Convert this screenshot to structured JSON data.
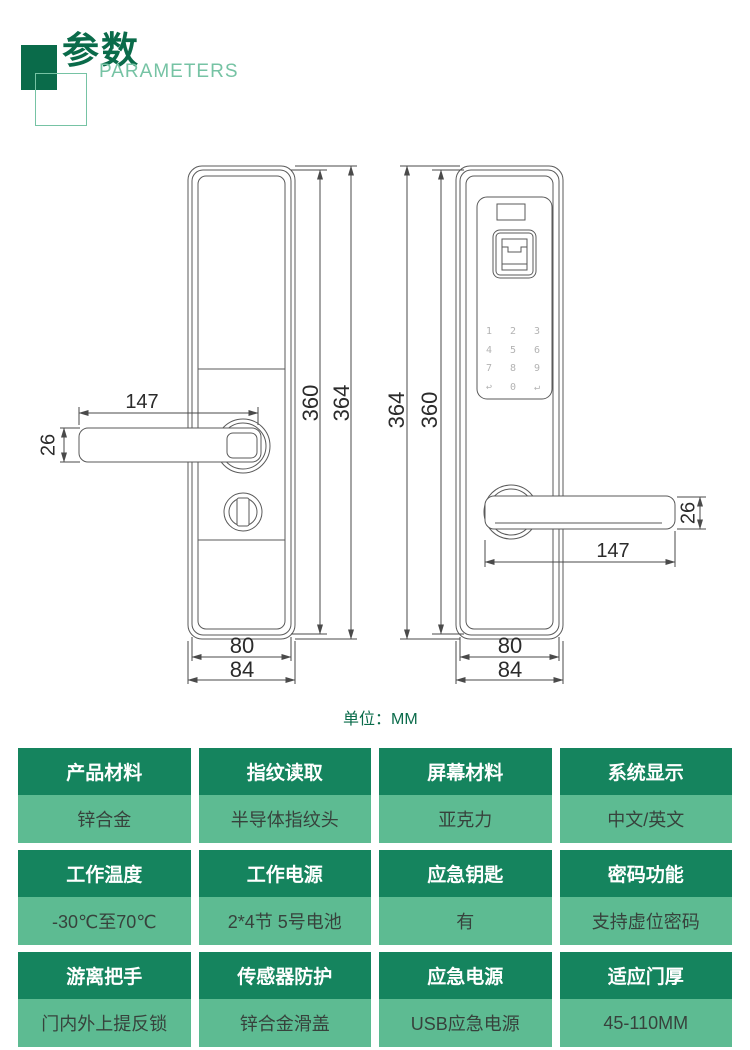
{
  "header": {
    "title": "参数",
    "subtitle": "PARAMETERS"
  },
  "colors": {
    "deep_green": "#0a6b4a",
    "light_green": "#76c3a4",
    "table_header_bg": "#15845e",
    "table_value_bg": "#5dbb92",
    "drawing_line": "#4a4a4a"
  },
  "drawing": {
    "unit_label": "单位：MM",
    "dimensions": {
      "handle_length": "147",
      "handle_height": "26",
      "body_height_inner": "360",
      "body_height_outer": "364",
      "body_width_inner": "80",
      "body_width_outer": "84"
    },
    "keypad_keys": [
      "1",
      "2",
      "3",
      "4",
      "5",
      "6",
      "7",
      "8",
      "9",
      "↩",
      "0",
      "↵"
    ]
  },
  "spec_table": {
    "rows": [
      {
        "cells": [
          {
            "label": "产品材料",
            "value": "锌合金"
          },
          {
            "label": "指纹读取",
            "value": "半导体指纹头"
          },
          {
            "label": "屏幕材料",
            "value": "亚克力"
          },
          {
            "label": "系统显示",
            "value": "中文/英文"
          }
        ]
      },
      {
        "cells": [
          {
            "label": "工作温度",
            "value": "-30℃至70℃"
          },
          {
            "label": "工作电源",
            "value": "2*4节 5号电池"
          },
          {
            "label": "应急钥匙",
            "value": "有"
          },
          {
            "label": "密码功能",
            "value": "支持虚位密码"
          }
        ]
      },
      {
        "cells": [
          {
            "label": "游离把手",
            "value": "门内外上提反锁"
          },
          {
            "label": "传感器防护",
            "value": "锌合金滑盖"
          },
          {
            "label": "应急电源",
            "value": "USB应急电源"
          },
          {
            "label": "适应门厚",
            "value": "45-110MM"
          }
        ]
      }
    ]
  }
}
